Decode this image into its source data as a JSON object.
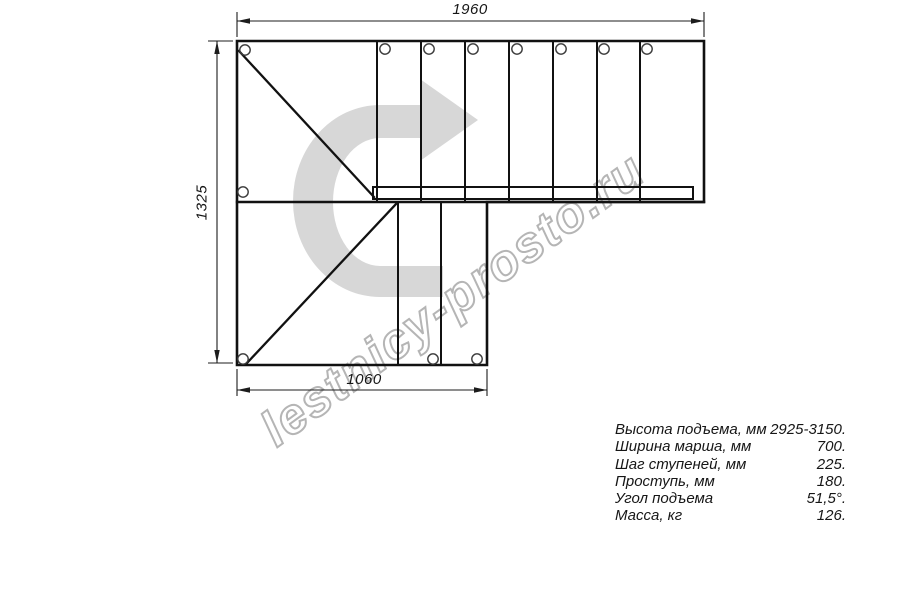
{
  "drawing": {
    "title": "staircase-plan-top-view",
    "dimensions": {
      "top": "1960",
      "left": "1325",
      "bottom": "1060"
    },
    "watermark": "lestnicy-prosto.ru",
    "icons": {
      "rotation_arrow": "u-turn-right-arrow"
    }
  },
  "specs": {
    "rows": [
      {
        "label": "Высота подъема, мм",
        "value": "2925-3150."
      },
      {
        "label": "Ширина марша, мм",
        "value": "700."
      },
      {
        "label": "Шаг ступеней, мм",
        "value": "225."
      },
      {
        "label": "Проступь, мм",
        "value": "180."
      },
      {
        "label": "Угол подъема",
        "value": "51,5°."
      },
      {
        "label": "Масса, кг",
        "value": "126."
      }
    ]
  },
  "colors": {
    "line": "#111111",
    "dim_line": "#1c1c1c",
    "arrow_fill": "#d7d7d7",
    "watermark_stroke": "#b5b5b5",
    "background": "#ffffff"
  }
}
